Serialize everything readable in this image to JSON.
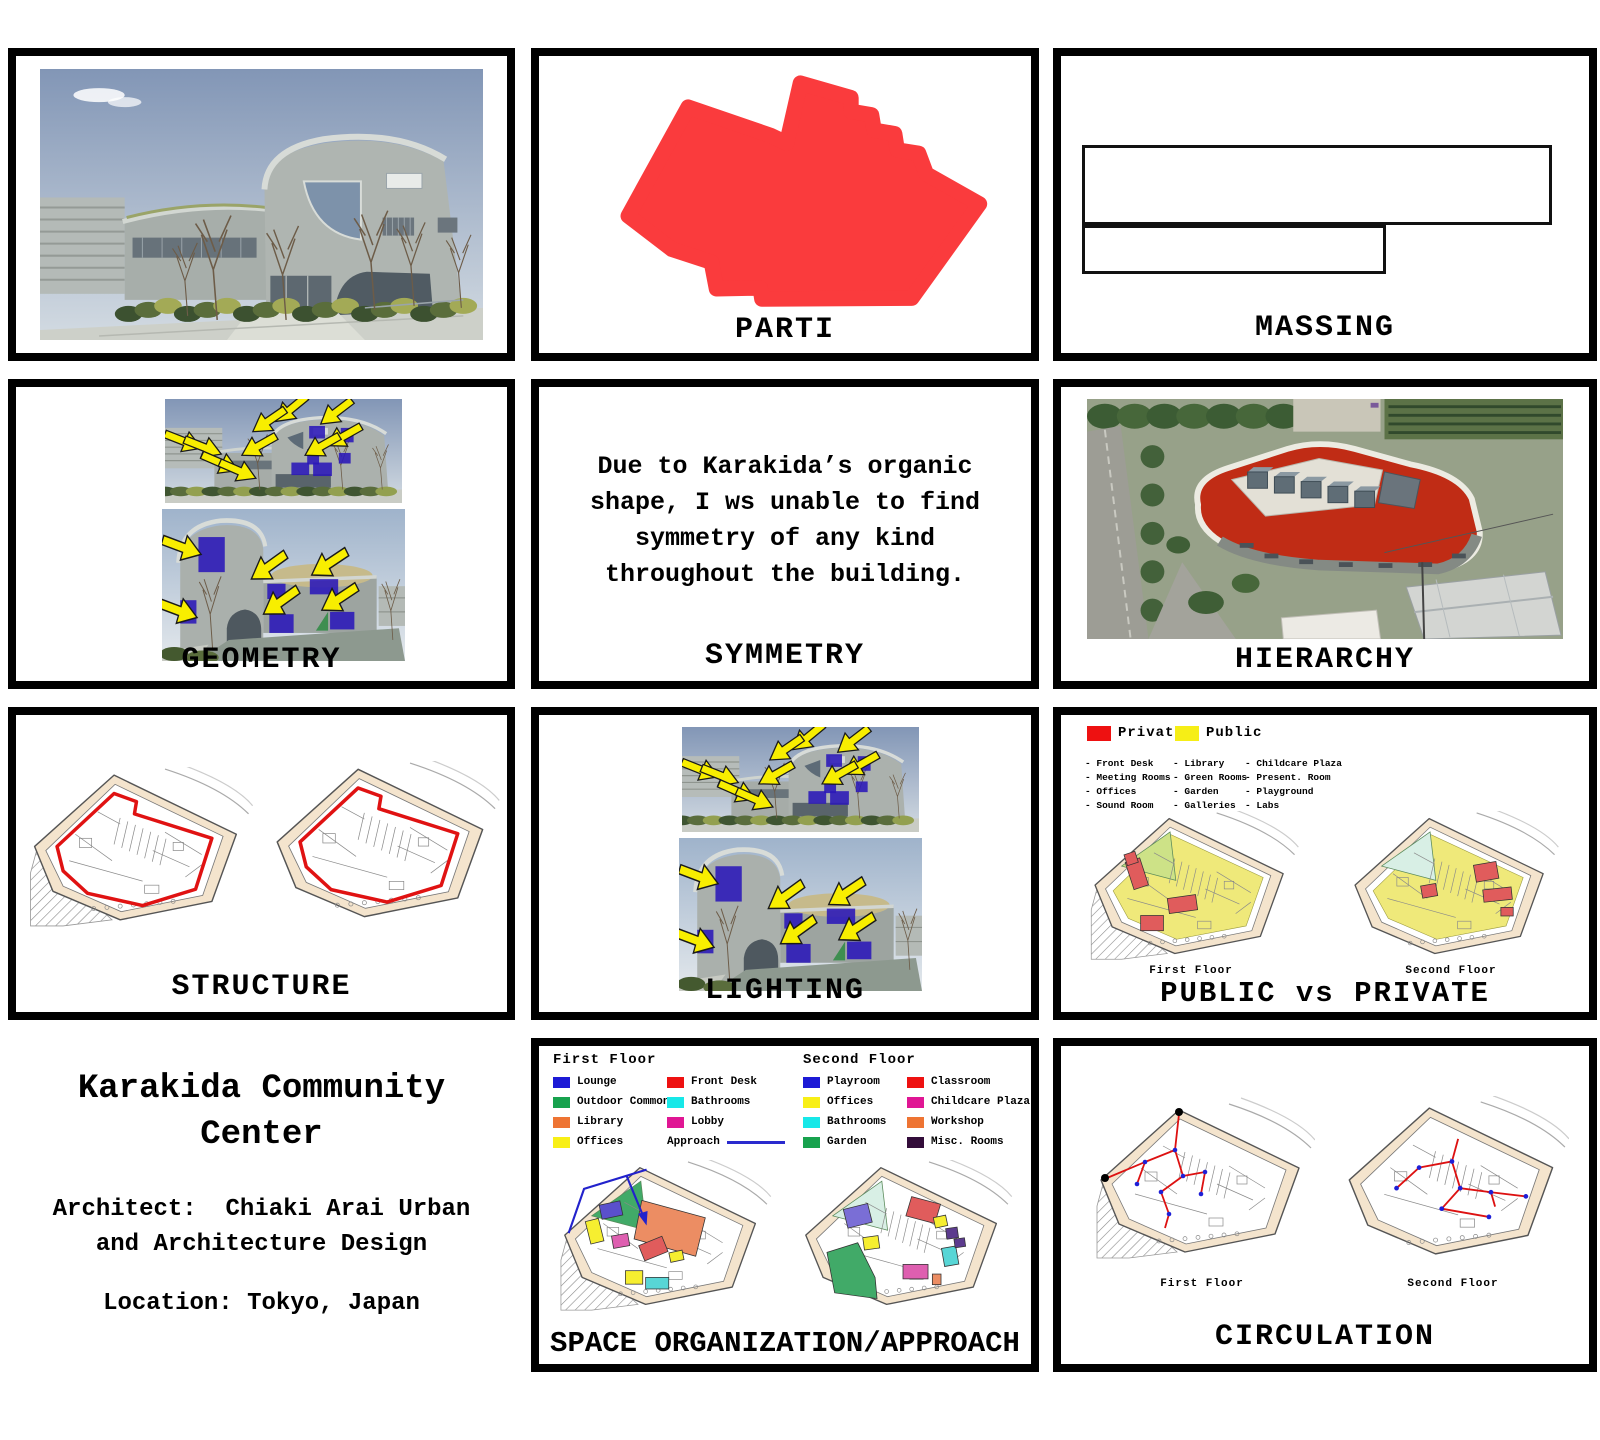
{
  "panels": {
    "parti": {
      "label": "PARTI"
    },
    "massing": {
      "label": "MASSING"
    },
    "geometry": {
      "label": "GEOMETRY"
    },
    "symmetry": {
      "label": "SYMMETRY",
      "text": "Due to Karakida’s organic shape, I ws unable to find symmetry of any kind throughout the building."
    },
    "hierarchy": {
      "label": "HIERARCHY"
    },
    "structure": {
      "label": "STRUCTURE"
    },
    "lighting": {
      "label": "LIGHTING"
    },
    "public_private": {
      "label": "PUBLIC vs PRIVATE",
      "floor1": "First Floor",
      "floor2": "Second Floor",
      "private": {
        "name": "Private",
        "color": "#ee1111",
        "items": [
          "- Front Desk",
          "- Meeting Rooms",
          "- Offices",
          "- Sound Room"
        ]
      },
      "public": {
        "name": "Public",
        "color": "#f6ee16",
        "items_a": [
          "- Library",
          "- Green Rooms",
          "- Garden",
          "- Galleries"
        ],
        "items_b": [
          "- Childcare Plaza",
          "- Present. Room",
          "- Playground",
          "- Labs"
        ]
      }
    },
    "space_org": {
      "label": "SPACE ORGANIZATION/APPROACH",
      "first_floor": {
        "title": "First Floor",
        "col1": [
          {
            "label": "Lounge",
            "color": "#1d1ad6"
          },
          {
            "label": "Outdoor Common",
            "color": "#17a24e"
          },
          {
            "label": "Library",
            "color": "#ee7433"
          },
          {
            "label": "Offices",
            "color": "#f8ef16"
          }
        ],
        "col2": [
          {
            "label": "Front Desk",
            "color": "#ee1111"
          },
          {
            "label": "Bathrooms",
            "color": "#17e8e8"
          },
          {
            "label": "Lobby",
            "color": "#e01694"
          }
        ],
        "approach": {
          "label": "Approach",
          "color": "#2a2ace"
        }
      },
      "second_floor": {
        "title": "Second Floor",
        "col1": [
          {
            "label": "Playroom",
            "color": "#1d1ad6"
          },
          {
            "label": "Offices",
            "color": "#f8ef16"
          },
          {
            "label": "Bathrooms",
            "color": "#17e8e8"
          },
          {
            "label": "Garden",
            "color": "#17a24e"
          }
        ],
        "col2": [
          {
            "label": "Classroom",
            "color": "#ee1111"
          },
          {
            "label": "Childcare Plaza",
            "color": "#e01694"
          },
          {
            "label": "Workshop",
            "color": "#ee7433"
          },
          {
            "label": "Misc. Rooms",
            "color": "#330d3a"
          }
        ]
      }
    },
    "circulation": {
      "label": "CIRCULATION",
      "floor1": "First Floor",
      "floor2": "Second Floor"
    },
    "title_block": {
      "project": "Karakida Community Center",
      "architect_line1": "Architect:  Chiaki Arai Urban",
      "architect_line2": "and Architecture Design",
      "location": "Location: Tokyo, Japan"
    }
  }
}
